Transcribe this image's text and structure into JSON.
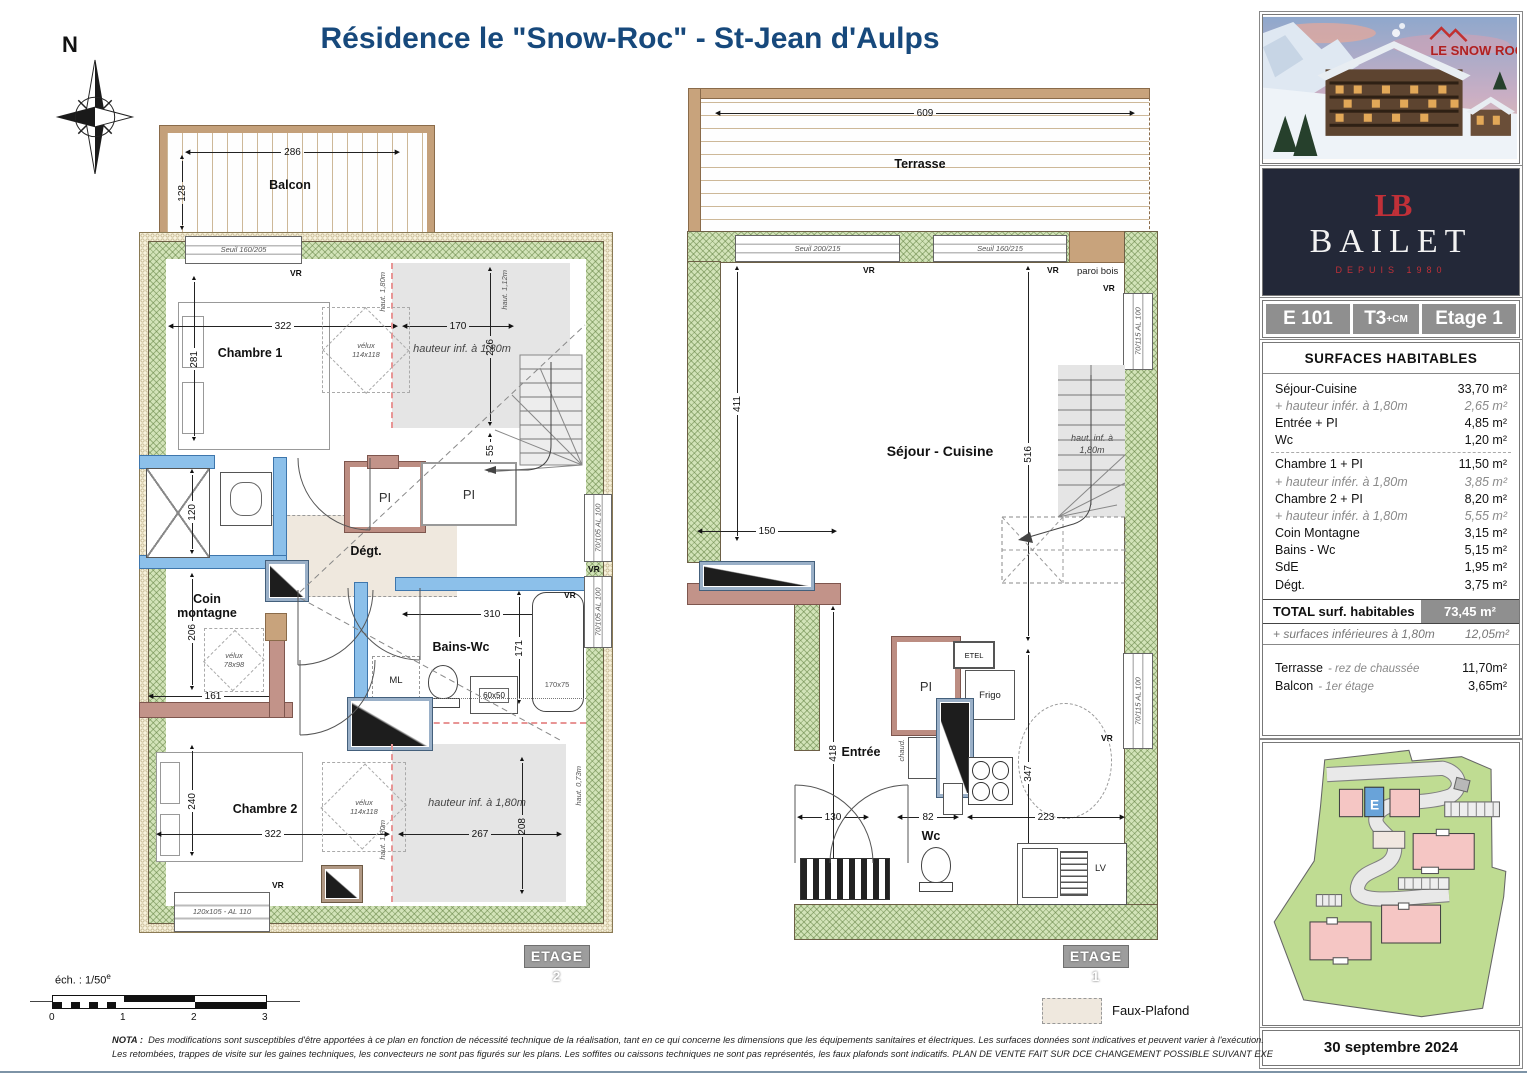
{
  "title": "Résidence le \"Snow-Roc\" - St-Jean d'Aulps",
  "compass_n": "N",
  "p2": {
    "floor_tag": "ETAGE 2",
    "balcon": "Balcon",
    "d286": "286",
    "d128": "128",
    "seuil1": "Seuil 160/205",
    "vr_top": "VR",
    "chambre1": "Chambre 1",
    "d322a": "322",
    "d281": "281",
    "d170": "170",
    "d226": "226",
    "haut180a": "haut. 1,80m",
    "haut112": "haut. 1,12m",
    "velux1a": "vélux",
    "velux1b": "114x118",
    "hinf1": "hauteur inf. à 1,80m",
    "d55": "55",
    "d65": "65",
    "pi1": "PI",
    "pi2": "PI",
    "d120": "120",
    "degt": "Dégt.",
    "coin": "Coin montagne",
    "d206": "206",
    "d161": "161",
    "velux2a": "vélux",
    "velux2b": "78x98",
    "bains": "Bains-Wc",
    "d310": "310",
    "d171": "171",
    "ml": "ML",
    "lav": "60x50",
    "bain": "170x75",
    "vr_bain": "VR",
    "vr_right": "VR",
    "win70105a": "70/105 AL 100",
    "win70105b": "70/105 AL 100",
    "chambre2": "Chambre 2",
    "d240": "240",
    "d322b": "322",
    "d267": "267",
    "d208": "208",
    "velux3a": "vélux",
    "velux3b": "114x118",
    "hinf2": "hauteur inf. à 1,80m",
    "haut073": "haut. 0,73m",
    "haut180b": "haut. 1,80m",
    "win120105": "120x105 - AL 110",
    "vr_c2": "VR"
  },
  "p1": {
    "floor_tag": "ETAGE 1",
    "terrasse": "Terrasse",
    "d609": "609",
    "seuil200": "Seuil 200/215",
    "seuil160": "Seuil 160/215",
    "vr_a": "VR",
    "vr_b": "VR",
    "paroi": "paroi bois",
    "sejour": "Séjour - Cuisine",
    "d411": "411",
    "d516": "516",
    "d150": "150",
    "d418": "418",
    "stair_note": "haut. inf. à 1,80m",
    "pi": "PI",
    "etel": "ETEL",
    "frigo": "Frigo",
    "chaud": "chaud.",
    "entree": "Entrée",
    "d130": "130",
    "d82": "82",
    "d223": "223",
    "d347": "347",
    "wc": "Wc",
    "lv": "LV",
    "vr_w1": "VR",
    "vr_w2": "VR",
    "win70115a": "70/115 AL 100",
    "win70115b": "70/115 AL 100"
  },
  "side": {
    "logo": "LE SNOW ROC",
    "brand_mono": "LB",
    "brand": "BAILET",
    "brand_since": "DEPUIS 1980",
    "unit_code": "E 101",
    "unit_type": "T3",
    "unit_type_sup": "+CM",
    "unit_floor": "Etage 1",
    "surf_title": "SURFACES HABITABLES",
    "rows": [
      {
        "l": "Séjour-Cuisine",
        "v": "33,70 m²"
      },
      {
        "l": "+ hauteur infér. à 1,80m",
        "v": "2,65 m²"
      },
      {
        "l": "Entrée + PI",
        "v": "4,85 m²"
      },
      {
        "l": "Wc",
        "v": "1,20 m²"
      },
      {
        "l": "Chambre 1 + PI",
        "v": "11,50 m²"
      },
      {
        "l": "+ hauteur infér. à 1,80m",
        "v": "3,85 m²"
      },
      {
        "l": "Chambre 2 + PI",
        "v": "8,20 m²"
      },
      {
        "l": "+ hauteur infér. à 1,80m",
        "v": "5,55 m²"
      },
      {
        "l": "Coin Montagne",
        "v": "3,15 m²"
      },
      {
        "l": "Bains - Wc",
        "v": "5,15 m²"
      },
      {
        "l": "SdE",
        "v": "1,95 m²"
      },
      {
        "l": "Dégt.",
        "v": "3,75 m²"
      }
    ],
    "total_l": "TOTAL surf. habitables",
    "total_v": "73,45 m²",
    "inf_l": "+ surfaces inférieures à 1,80m",
    "inf_v": "12,05m²",
    "ter_l": "Terrasse",
    "ter_n": "- rez de chaussée",
    "ter_v": "11,70m²",
    "bal_l": "Balcon",
    "bal_n": "- 1er étage",
    "bal_v": "3,65m²",
    "map_e": "E",
    "date": "30 septembre 2024"
  },
  "footer": {
    "ech": "éch. : 1/50",
    "ech_sup": "e",
    "t0": "0",
    "t1": "1",
    "t2": "2",
    "t3": "3",
    "nota_l": "NOTA :",
    "nota1": "Des modifications sont susceptibles d'être apportées à ce plan en fonction de nécessité technique de la réalisation, tant en ce qui concerne les dimensions que les équipements sanitaires et électriques. Les surfaces données sont indicatives et peuvent varier à l'exécution.",
    "nota2": "Les retombées, trappes de visite sur les gaines techniques, les convecteurs ne sont pas figurés sur les plans. Les soffites ou caissons techniques ne sont pas représentés, les faux plafonds sont indicatifs. PLAN DE VENTE FAIT SUR DCE CHANGEMENT POSSIBLE SUIVANT EXE",
    "faux": "Faux-Plafond"
  },
  "colors": {
    "title_blue": "#17497c",
    "brand_navy": "#232838",
    "brand_red": "#c03038",
    "wall_green": "#d2e3b8",
    "tag_gray": "#9d9d9d"
  }
}
